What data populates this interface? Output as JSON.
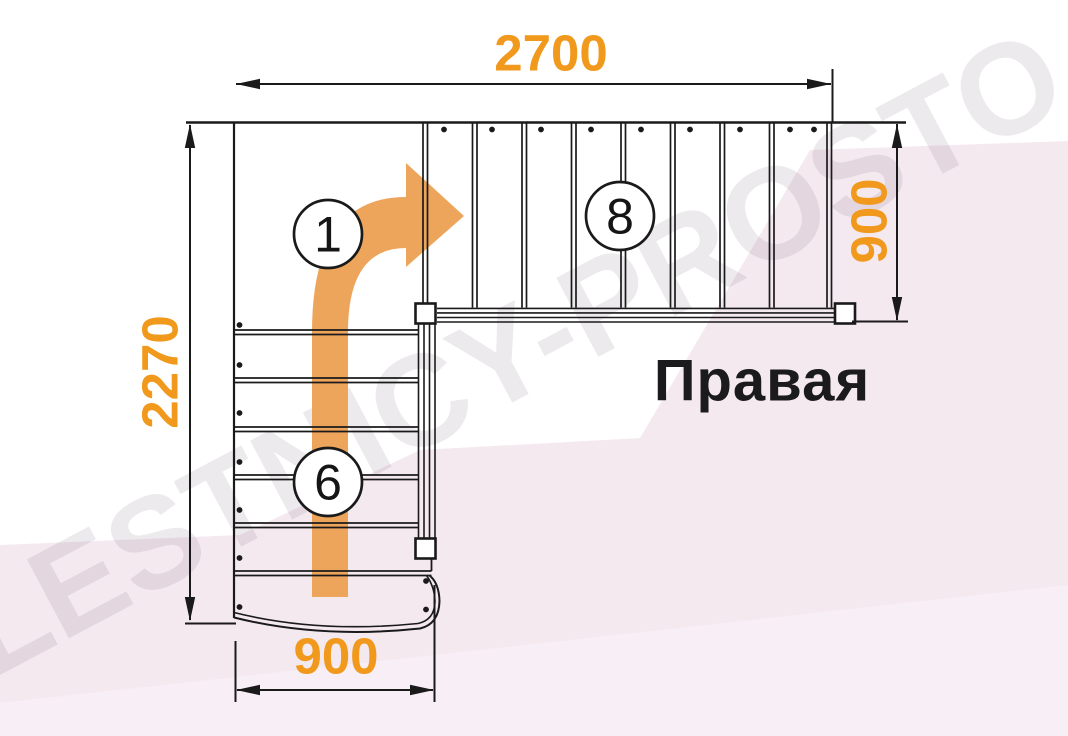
{
  "title": {
    "label": "Правая"
  },
  "watermark": {
    "text": "LESTNICY-PROSTO.RU"
  },
  "dimensions": {
    "top": {
      "value": "2700"
    },
    "left": {
      "value": "2270"
    },
    "right": {
      "value": "900"
    },
    "bottom": {
      "value": "900"
    }
  },
  "markers": {
    "start": {
      "label": "1"
    },
    "lower_flight": {
      "label": "6"
    },
    "upper_flight": {
      "label": "8"
    }
  },
  "plan": {
    "lower_flight_steps": 6,
    "upper_flight_steps": 8,
    "direction": "up-then-right-turn"
  },
  "colors": {
    "dimension_text": "#f0991c",
    "arrow_orange": "#eda55c",
    "line": "#1a1a1a",
    "background": "#ffffff",
    "background_pink": "#f5e9f0"
  }
}
